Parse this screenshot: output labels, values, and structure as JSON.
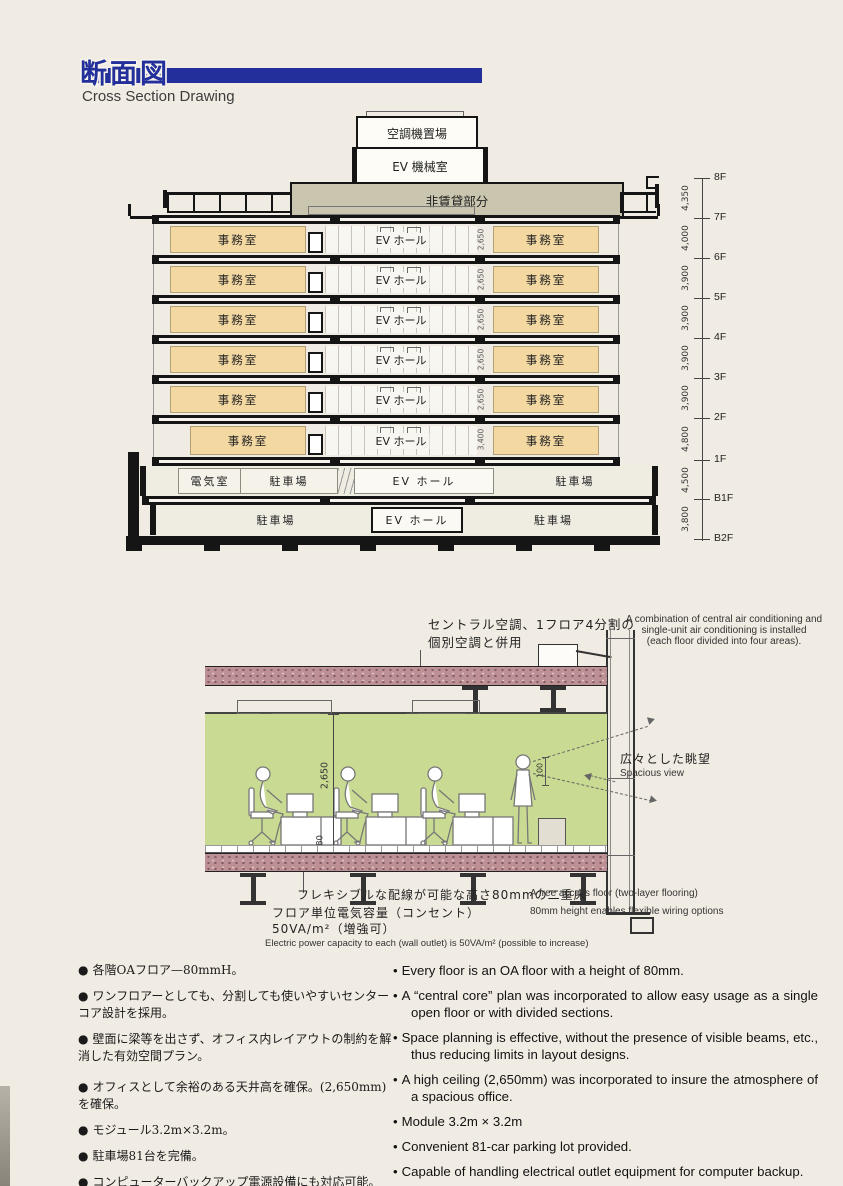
{
  "header": {
    "title_jp": "断面図",
    "title_en": "Cross Section Drawing"
  },
  "building": {
    "rooftop": {
      "ac_room": "空調機置場",
      "ev_machine_room": "EV 機械室",
      "non_rental": "非賃貸部分"
    },
    "office_floors": [
      {
        "left": "事務室",
        "center": "EV ホール",
        "dim": "2,650",
        "right": "事務室"
      },
      {
        "left": "事務室",
        "center": "EV ホール",
        "dim": "2,650",
        "right": "事務室"
      },
      {
        "left": "事務室",
        "center": "EV ホール",
        "dim": "2,650",
        "right": "事務室"
      },
      {
        "left": "事務室",
        "center": "EV ホール",
        "dim": "2,650",
        "right": "事務室"
      },
      {
        "left": "事務室",
        "center": "EV ホール",
        "dim": "2,650",
        "right": "事務室"
      },
      {
        "left": "事務室",
        "center": "EV ホール",
        "dim": "3,400",
        "right": "事務室"
      }
    ],
    "b1f": {
      "c1": "電気室",
      "c2": "駐車場",
      "c3": "EV ホール",
      "c4": "駐車場"
    },
    "b2f": {
      "c1": "駐車場",
      "c2": "EV ホール",
      "c3": "駐車場"
    },
    "levels": [
      "8F",
      "7F",
      "6F",
      "5F",
      "4F",
      "3F",
      "2F",
      "1F",
      "B1F",
      "B2F"
    ],
    "level_dims": [
      "4,350",
      "4,000",
      "3,900",
      "3,900",
      "3,900",
      "3,900",
      "4,800",
      "4,500",
      "3,800"
    ]
  },
  "interior": {
    "ac_note_jp1": "セントラル空調、1フロア4分割の",
    "ac_note_jp2": "個別空調と併用",
    "ac_note_en1": "A combination of central air conditioning and",
    "ac_note_en2": "single-unit air conditioning is installed",
    "ac_note_en3": "(each floor divided into four areas).",
    "ceiling_height": "2,650",
    "raised_floor_height": "80",
    "window_dim": "100",
    "view_jp": "広々とした眺望",
    "view_en": "Spacious view",
    "floor_note_jp": "フレキシブルな配線が可能な高さ80mmの二重床",
    "floor_note_en1": "A free access floor (two-layer flooring)",
    "floor_note_en2": "80mm height enables flexible wiring options",
    "power_note_jp1": "フロア単位電気容量（コンセント）",
    "power_note_jp2": "50VA/m²（増強可）",
    "power_note_en": "Electric power capacity to each (wall outlet) is 50VA/m² (possible to increase)"
  },
  "features": {
    "jp": [
      "各階OAフロア—80mmH。",
      "ワンフロアーとしても、分割しても使いやすいセンターコア設計を採用。",
      "壁面に梁等を出さず、オフィス内レイアウトの制約を解消した有効空間プラン。",
      "オフィスとして余裕のある天井高を確保。(2,650mm)を確保。",
      "モジュール3.2m×3.2m。",
      "駐車場81台を完備。",
      "コンピューターバックアップ電源設備にも対応可能。"
    ],
    "en": [
      "Every floor is an OA floor with a height of 80mm.",
      "A “central core” plan was incorporated to allow easy usage as a single open floor or with divided sections.",
      "Space planning is effective, without the presence of visible beams, etc., thus reducing limits in layout designs.",
      "A high ceiling (2,650mm) was incorporated to insure the atmosphere of a spacious office.",
      "Module 3.2m × 3.2m",
      "Convenient 81-car parking lot provided.",
      "Capable of handling electrical outlet equipment for computer backup."
    ]
  },
  "colors": {
    "accent_blue": "#232f9b",
    "office_tan": "#f3d8a2",
    "penthouse_grey": "#c9c5ae",
    "room_green": "#c9db92",
    "slab_speckle": "#bc9094"
  }
}
